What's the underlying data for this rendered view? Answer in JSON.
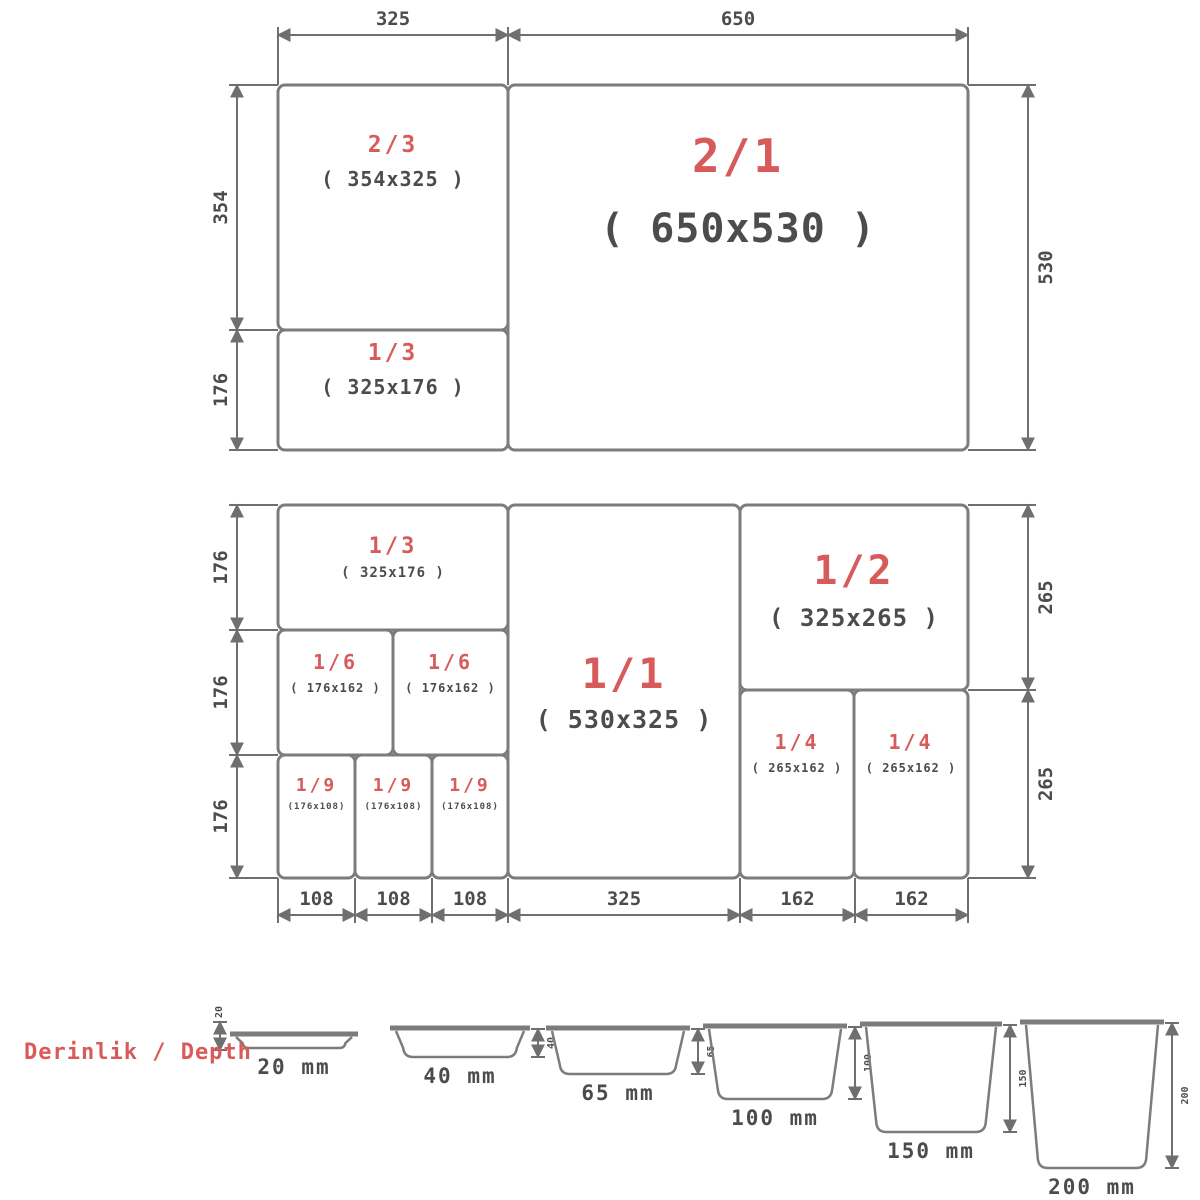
{
  "colors": {
    "line": "#7c7c7c",
    "dim_line": "#6f6f6f",
    "red": "#d85b5b",
    "text": "#4c4c4c"
  },
  "depth_section": {
    "label": "Derinlik / Depth",
    "pans": [
      {
        "name": "pan-20mm",
        "size_label": "20 mm",
        "tick": "20",
        "x": 232,
        "rim_y": 1034,
        "w": 124,
        "depth": 14,
        "dim_side": "left"
      },
      {
        "name": "pan-40mm",
        "size_label": "40 mm",
        "tick": "40",
        "x": 392,
        "rim_y": 1028,
        "w": 136,
        "depth": 29,
        "dim_side": "right"
      },
      {
        "name": "pan-65mm",
        "size_label": "65 mm",
        "tick": "65",
        "x": 548,
        "rim_y": 1028,
        "w": 140,
        "depth": 46,
        "dim_side": "right"
      },
      {
        "name": "pan-100mm",
        "size_label": "100 mm",
        "tick": "100",
        "x": 705,
        "rim_y": 1026,
        "w": 140,
        "depth": 73,
        "dim_side": "right"
      },
      {
        "name": "pan-150mm",
        "size_label": "150 mm",
        "tick": "150",
        "x": 862,
        "rim_y": 1024,
        "w": 138,
        "depth": 108,
        "dim_side": "right"
      },
      {
        "name": "pan-200mm",
        "size_label": "200 mm",
        "tick": "200",
        "x": 1022,
        "rim_y": 1022,
        "w": 140,
        "depth": 146,
        "dim_side": "right"
      }
    ]
  },
  "assemblies": [
    {
      "name": "top-assembly",
      "boxes": [
        {
          "name": "panel-2-3",
          "fraction": "2/3",
          "size": "( 354x325 )",
          "x": 278,
          "y": 85,
          "w": 230,
          "h": 245,
          "fy": 152,
          "sy": 186,
          "ffs": 23,
          "sfs": 20
        },
        {
          "name": "panel-1-3",
          "fraction": "1/3",
          "size": "( 325x176 )",
          "x": 278,
          "y": 330,
          "w": 230,
          "h": 120,
          "fy": 360,
          "sy": 394,
          "ffs": 23,
          "sfs": 20
        },
        {
          "name": "panel-2-1",
          "fraction": "2/1",
          "size": "( 650x530 )",
          "x": 508,
          "y": 85,
          "w": 460,
          "h": 365,
          "fy": 172,
          "sy": 242,
          "ffs": 46,
          "sfs": 40
        }
      ],
      "dims": [
        {
          "dir": "h",
          "label": "325",
          "line": 35,
          "a": 278,
          "b": 508,
          "ext": 85
        },
        {
          "dir": "h",
          "label": "650",
          "line": 35,
          "a": 508,
          "b": 968,
          "ext": 85
        },
        {
          "dir": "v",
          "label": "354",
          "line": 237,
          "a": 85,
          "b": 330,
          "ext": 278
        },
        {
          "dir": "v",
          "label": "176",
          "line": 237,
          "a": 330,
          "b": 450,
          "ext": 278
        },
        {
          "dir": "v",
          "label": "530",
          "line": 1028,
          "a": 85,
          "b": 450,
          "ext": 968
        }
      ]
    },
    {
      "name": "middle-assembly",
      "boxes": [
        {
          "name": "panel-1-3-mid",
          "fraction": "1/3",
          "size": "( 325x176 )",
          "x": 278,
          "y": 505,
          "w": 230,
          "h": 125,
          "fy": 553,
          "sy": 577,
          "ffs": 22,
          "sfs": 14
        },
        {
          "name": "panel-1-6-a",
          "fraction": "1/6",
          "size": "( 176x162 )",
          "x": 278,
          "y": 630,
          "w": 115,
          "h": 125,
          "fy": 669,
          "sy": 692,
          "ffs": 20,
          "sfs": 12
        },
        {
          "name": "panel-1-6-b",
          "fraction": "1/6",
          "size": "( 176x162 )",
          "x": 393,
          "y": 630,
          "w": 115,
          "h": 125,
          "fy": 669,
          "sy": 692,
          "ffs": 20,
          "sfs": 12
        },
        {
          "name": "panel-1-9-a",
          "fraction": "1/9",
          "size": "(176x108)",
          "x": 278,
          "y": 755,
          "w": 77,
          "h": 123,
          "fy": 791,
          "sy": 809,
          "ffs": 18,
          "sfs": 9
        },
        {
          "name": "panel-1-9-b",
          "fraction": "1/9",
          "size": "(176x108)",
          "x": 355,
          "y": 755,
          "w": 77,
          "h": 123,
          "fy": 791,
          "sy": 809,
          "ffs": 18,
          "sfs": 9
        },
        {
          "name": "panel-1-9-c",
          "fraction": "1/9",
          "size": "(176x108)",
          "x": 432,
          "y": 755,
          "w": 76,
          "h": 123,
          "fy": 791,
          "sy": 809,
          "ffs": 18,
          "sfs": 9
        },
        {
          "name": "panel-1-1",
          "fraction": "1/1",
          "size": "( 530x325 )",
          "x": 508,
          "y": 505,
          "w": 232,
          "h": 373,
          "fy": 688,
          "sy": 728,
          "ffs": 42,
          "sfs": 25
        },
        {
          "name": "panel-1-2",
          "fraction": "1/2",
          "size": "( 325x265 )",
          "x": 740,
          "y": 505,
          "w": 228,
          "h": 185,
          "fy": 584,
          "sy": 626,
          "ffs": 40,
          "sfs": 24
        },
        {
          "name": "panel-1-4-a",
          "fraction": "1/4",
          "size": "( 265x162 )",
          "x": 740,
          "y": 690,
          "w": 114,
          "h": 188,
          "fy": 749,
          "sy": 772,
          "ffs": 20,
          "sfs": 12
        },
        {
          "name": "panel-1-4-b",
          "fraction": "1/4",
          "size": "( 265x162 )",
          "x": 854,
          "y": 690,
          "w": 114,
          "h": 188,
          "fy": 749,
          "sy": 772,
          "ffs": 20,
          "sfs": 12
        }
      ],
      "dims": [
        {
          "dir": "v",
          "label": "176",
          "line": 237,
          "a": 505,
          "b": 630,
          "ext": 278
        },
        {
          "dir": "v",
          "label": "176",
          "line": 237,
          "a": 630,
          "b": 755,
          "ext": 278
        },
        {
          "dir": "v",
          "label": "176",
          "line": 237,
          "a": 755,
          "b": 878,
          "ext": 278
        },
        {
          "dir": "v",
          "label": "265",
          "line": 1028,
          "a": 505,
          "b": 690,
          "ext": 968
        },
        {
          "dir": "v",
          "label": "265",
          "line": 1028,
          "a": 690,
          "b": 878,
          "ext": 968
        },
        {
          "dir": "h",
          "label": "108",
          "line": 915,
          "a": 278,
          "b": 355,
          "ext": 878
        },
        {
          "dir": "h",
          "label": "108",
          "line": 915,
          "a": 355,
          "b": 432,
          "ext": 878
        },
        {
          "dir": "h",
          "label": "108",
          "line": 915,
          "a": 432,
          "b": 508,
          "ext": 878
        },
        {
          "dir": "h",
          "label": "325",
          "line": 915,
          "a": 508,
          "b": 740,
          "ext": 878
        },
        {
          "dir": "h",
          "label": "162",
          "line": 915,
          "a": 740,
          "b": 855,
          "ext": 878
        },
        {
          "dir": "h",
          "label": "162",
          "line": 915,
          "a": 855,
          "b": 968,
          "ext": 878
        }
      ]
    }
  ]
}
